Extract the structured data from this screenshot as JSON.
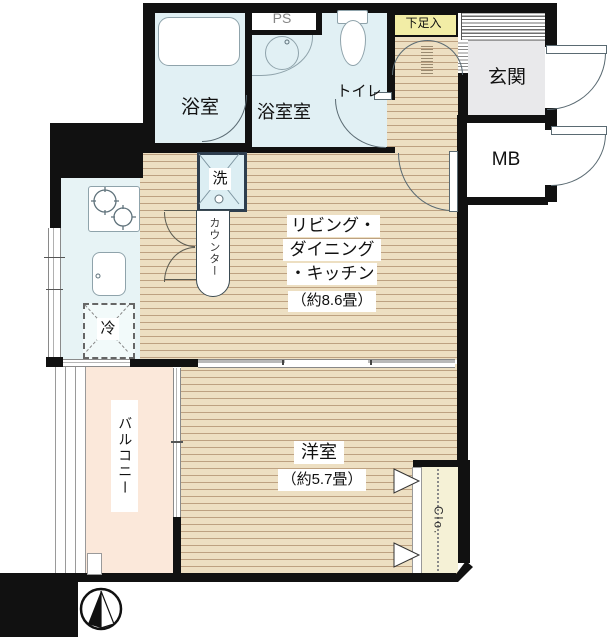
{
  "rooms": {
    "bath": "浴室",
    "ps": "PS",
    "washroom": "浴室室",
    "toilet": "トイレ",
    "shoe_cabinet": "下足入",
    "entrance": "玄関",
    "meter_box": "MB",
    "washer": "洗",
    "counter": "カウンター",
    "fridge": "冷",
    "ldk": [
      "リビング・",
      "ダイニング",
      "・キッチン"
    ],
    "ldk_size": "（約8.6畳）",
    "western_room": "洋室",
    "western_size": "（約5.7畳）",
    "balcony": "バルコニー",
    "closet": "Clo."
  },
  "colors": {
    "wall": "#111111",
    "floor_wood": "#eddfc2",
    "floor_stripe": "#bda181",
    "wet_area_blue": "#e1f0f4",
    "kitchen_blue": "#e7f3f5",
    "entrance_gray": "#e9e9eb",
    "shoe_cabinet_yellow": "#f2eda6",
    "closet_yellow": "#f5f1d6",
    "balcony_pink": "#fbe8da",
    "ps_text_gray": "#858585"
  }
}
